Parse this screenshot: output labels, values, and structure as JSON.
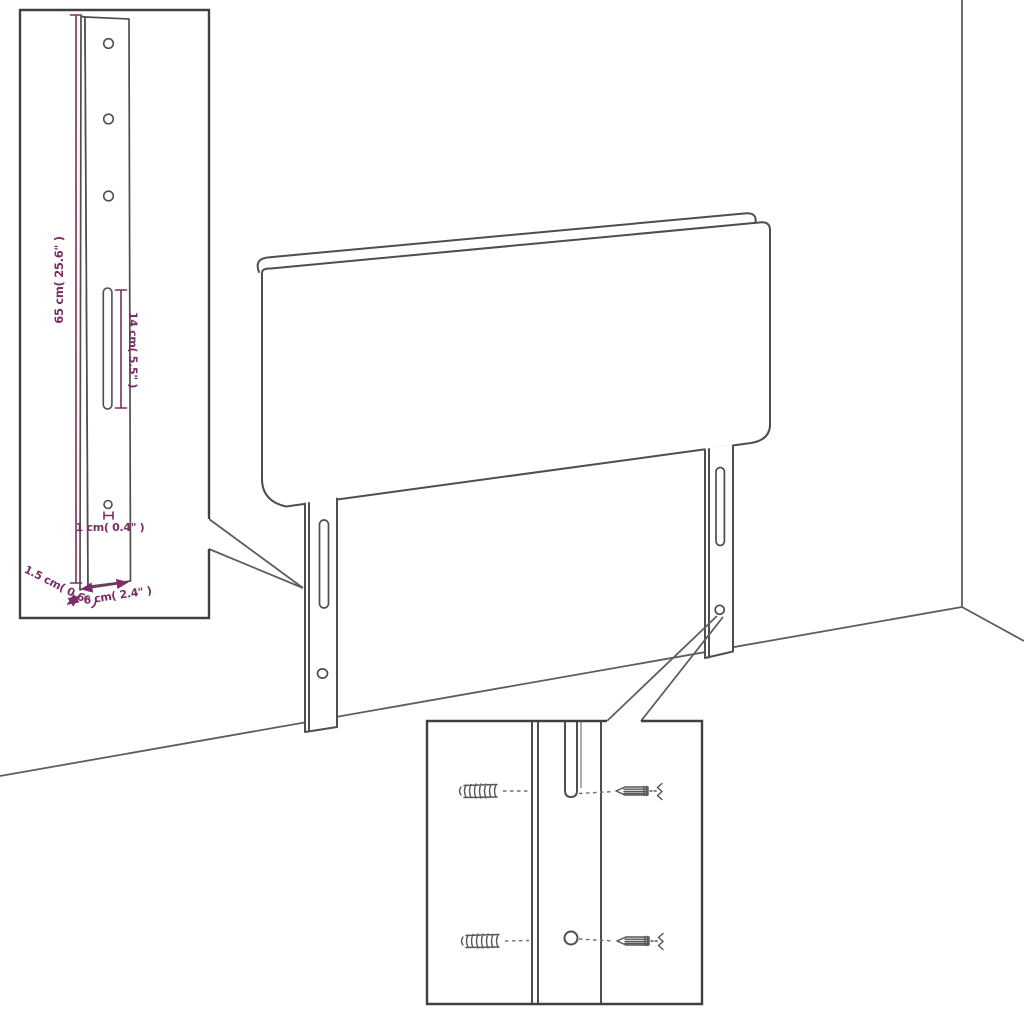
{
  "diagram": {
    "kind": "product-dimension-diagram",
    "subject": "upholstered headboard with two slotted mounting legs",
    "colors": {
      "dimension_accent": "#7c2d63",
      "line_art": "#4d4e50",
      "background": "#ffffff"
    },
    "leg_detail_inset": {
      "height_label": "65 cm( 25.6\" )",
      "slot_label": "14 cm( 5.5\" )",
      "hole_label": "1 cm( 0.4\" )",
      "depth_label": "1.5 cm( 0.6\" )",
      "width_label": "6 cm( 2.4\" )"
    },
    "mounting_inset": {
      "icons": [
        "wall-plug-icon",
        "screw-icon",
        "keyhole-slot",
        "screw-hole"
      ]
    }
  }
}
